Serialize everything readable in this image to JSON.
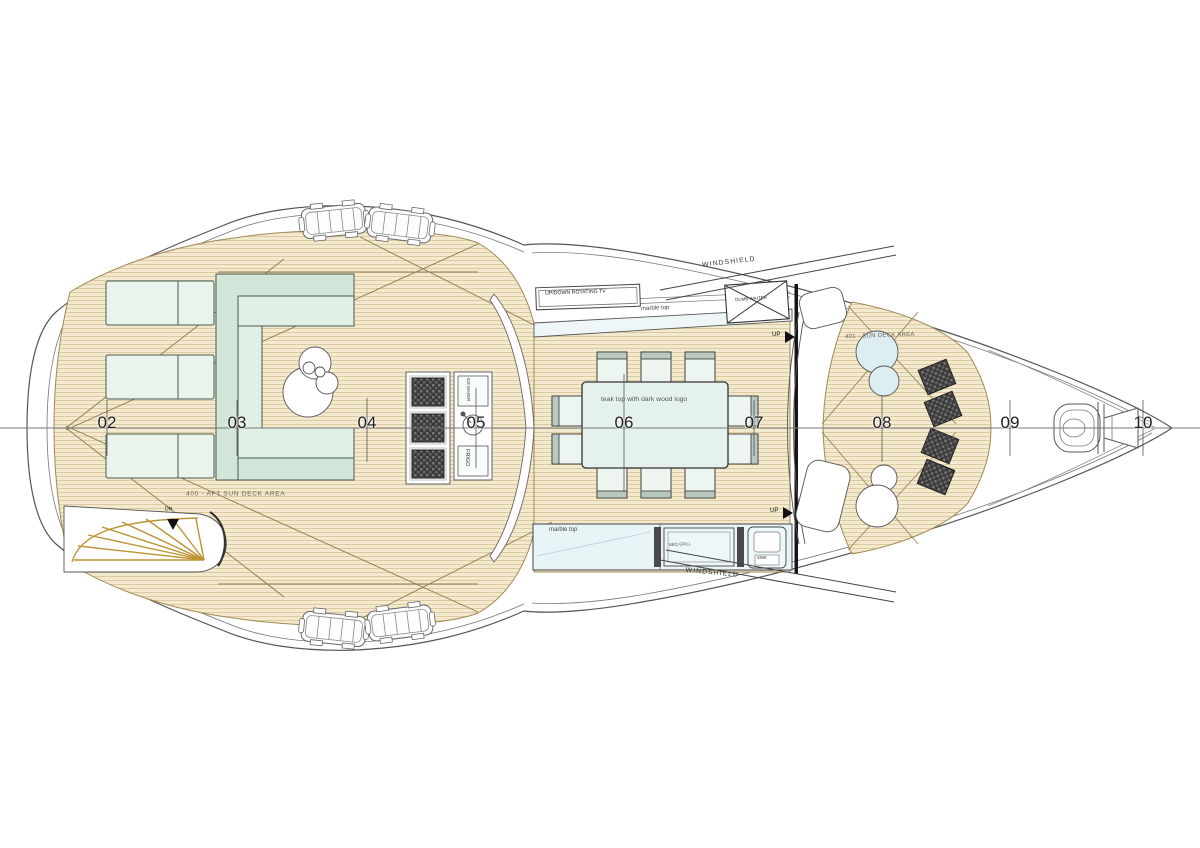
{
  "plan": {
    "stations": [
      "02",
      "03",
      "04",
      "05",
      "06",
      "07",
      "08",
      "09",
      "10"
    ],
    "areas": {
      "aft_sun_deck": "400 - AFT SUN DECK AREA",
      "fore_sun_deck": "401 - SUN DECK AREA"
    },
    "labels": {
      "windshield_top": "WINDSHIELD",
      "windshield_bottom": "WINDSHIELD",
      "rotating_tv": "UP/DOWN ROTATING TV",
      "marble_top_upper": "marble top",
      "marble_top_lower": "marble top",
      "dining_table": "teak top with dark wood logo",
      "dumb_waiter": "DUMB WAITER",
      "fridge": "FRIGO",
      "ice_maker": "ICE MAKER",
      "sink": "SINK",
      "bbq_grill": "BBQ GRILL",
      "up_stairs_top": "UP",
      "up_stairs_bottom": "UP",
      "down_stairs": "DN"
    },
    "colors": {
      "teak": "#f3e9ce",
      "teak_line": "#d8c393",
      "upholstery_mint": "#e1f0e7",
      "marble": "#e9f4f6",
      "pad_dark": "#3b3b3b",
      "stair_gold": "#bd9434",
      "line": "#4a4a4a"
    }
  }
}
